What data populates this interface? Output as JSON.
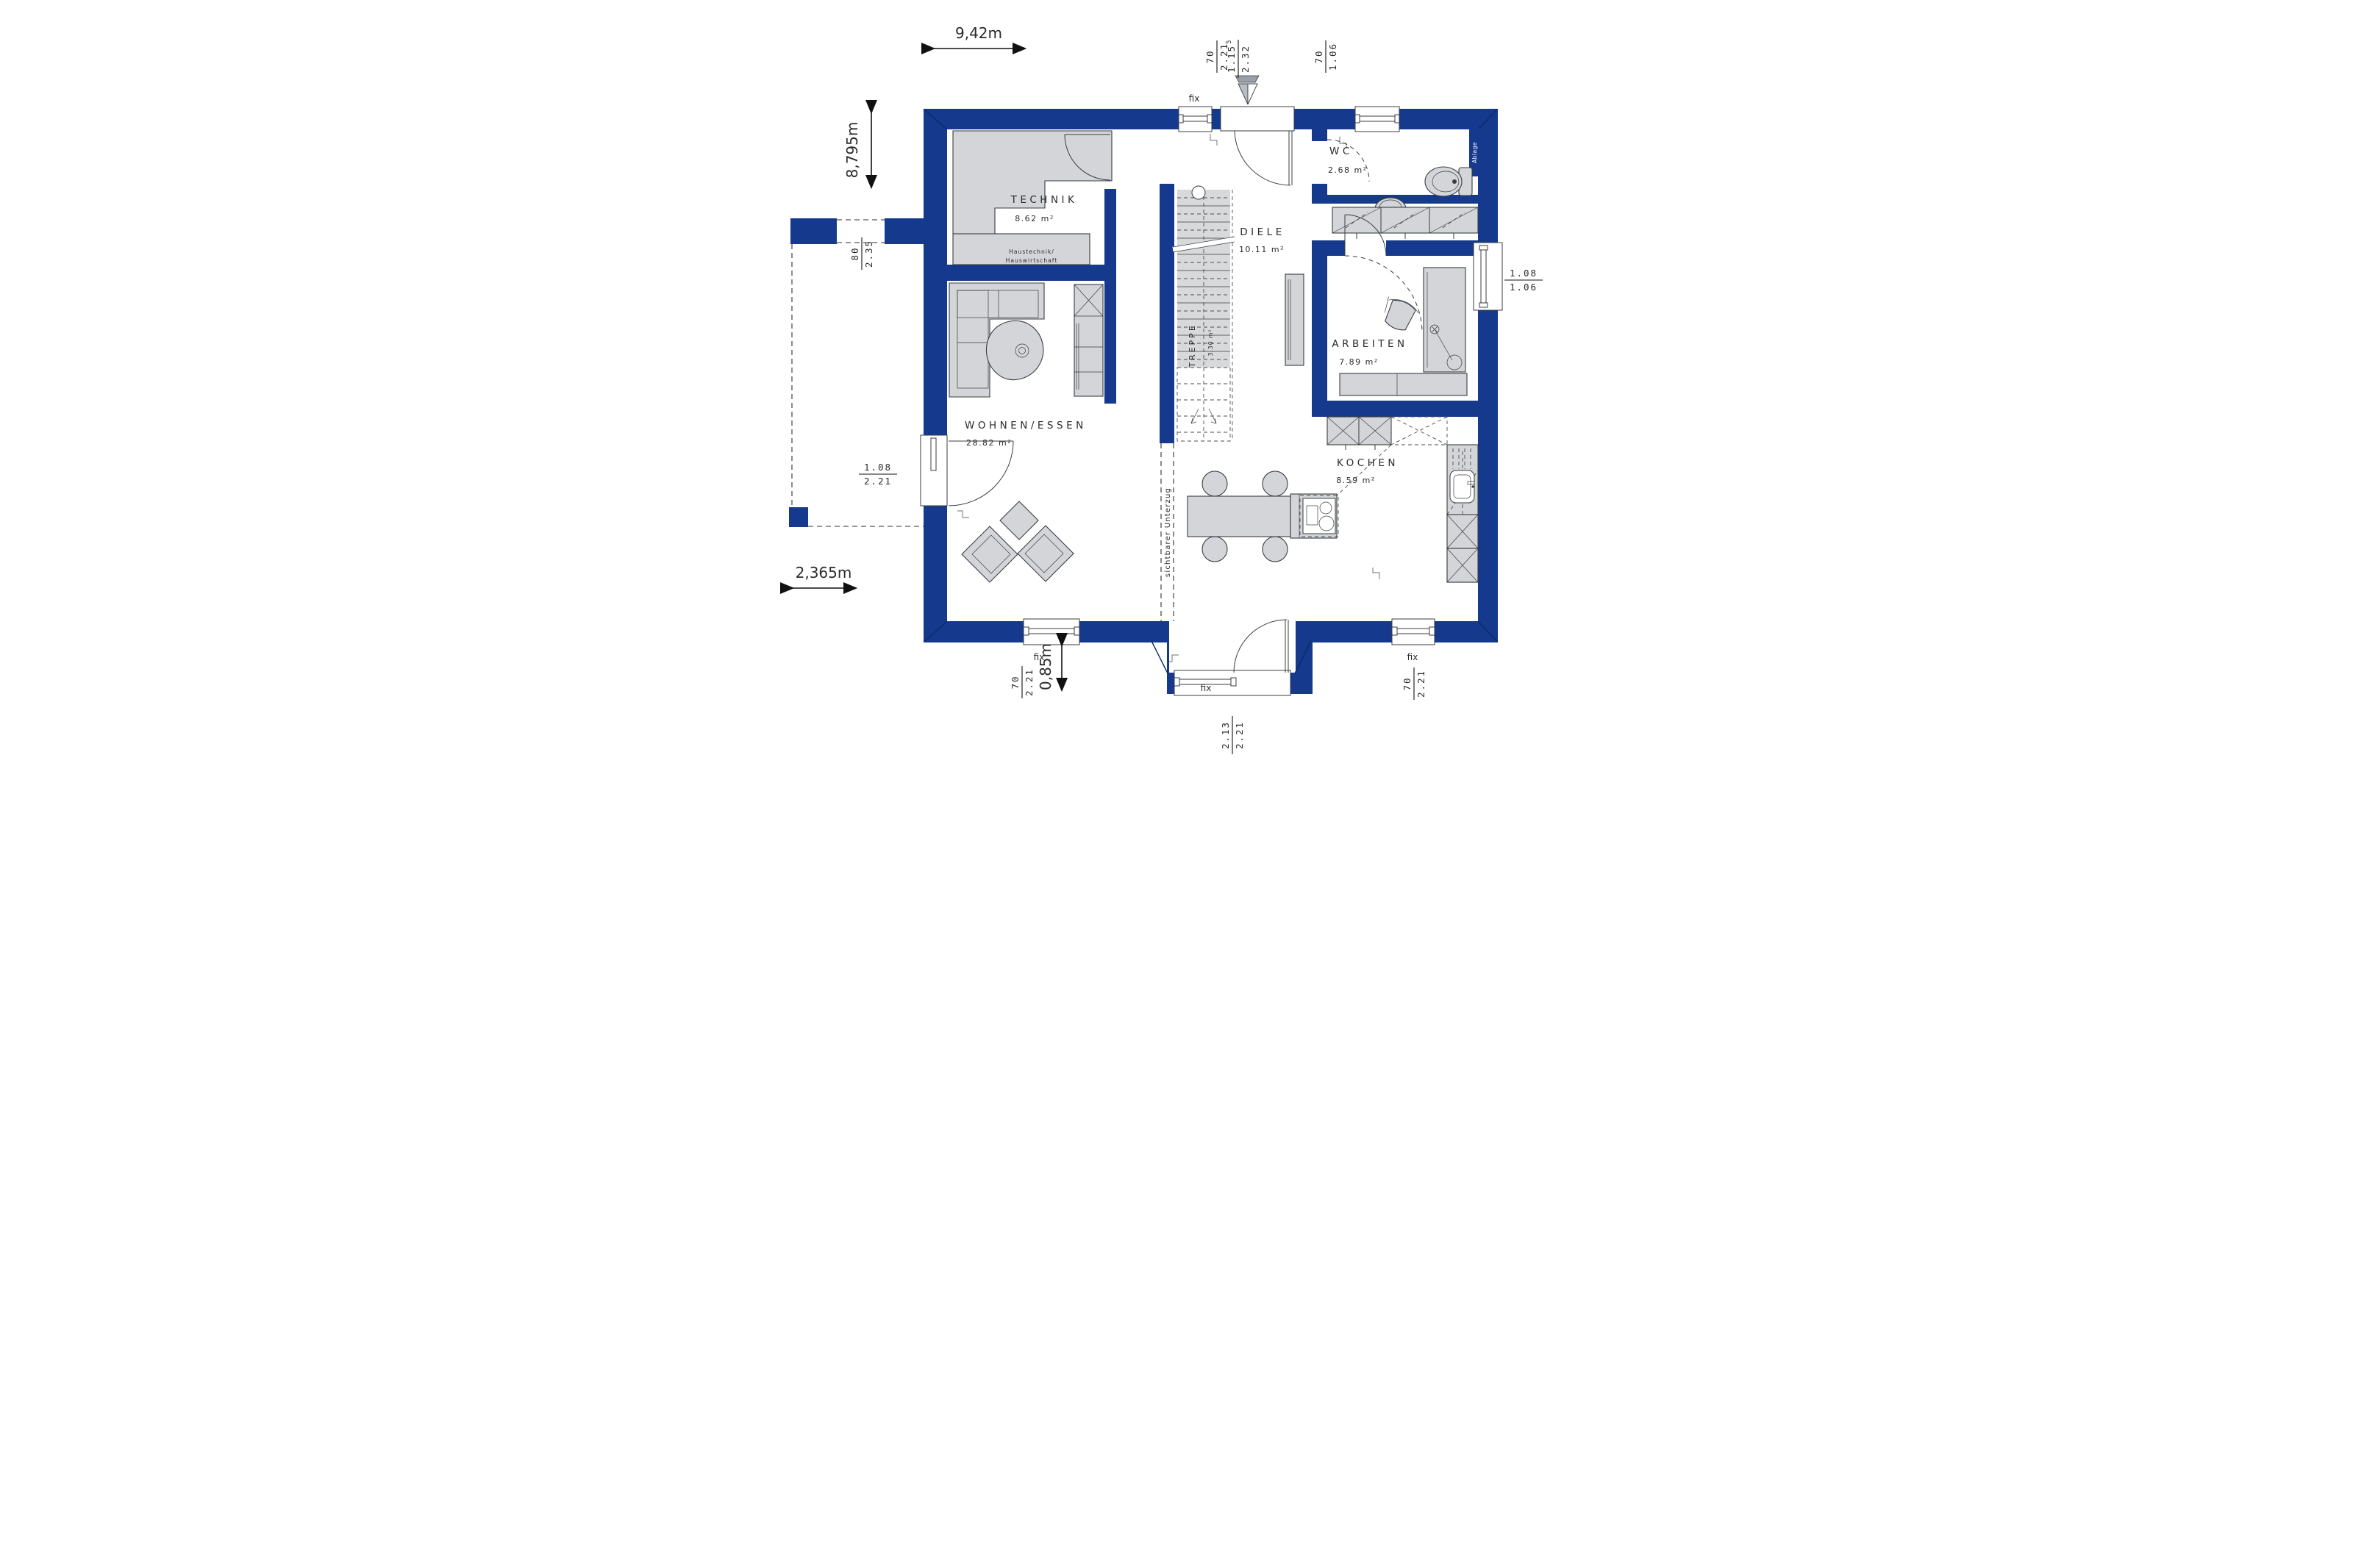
{
  "rooms": {
    "technik": {
      "name": "TECHNIK",
      "area": "8.62 m²",
      "note1": "Haustechnik/",
      "note2": "Hauswirtschaft"
    },
    "wc": {
      "name": "WC",
      "area": "2.68 m²"
    },
    "diele": {
      "name": "DIELE",
      "area": "10.11 m²"
    },
    "treppe": {
      "name": "TREPPE",
      "area": "3.30 m²"
    },
    "arbeiten": {
      "name": "ARBEITEN",
      "area": "7.89 m²"
    },
    "wohnen_essen": {
      "name": "WOHNEN/ESSEN",
      "area": "28.82 m²"
    },
    "kochen": {
      "name": "KOCHEN",
      "area": "8.59 m²"
    }
  },
  "overall_dimensions": {
    "width": "9,42m",
    "depth": "8,795m",
    "carport_width": "2,365m",
    "recess": "0,85m"
  },
  "annotations": {
    "beam": "sichtbarer Unterzug",
    "shelf": "Ablage",
    "fix": "fix"
  },
  "openings": {
    "top_window": {
      "w": "70",
      "h": "2.21"
    },
    "entrance_door": {
      "w": "1.15",
      "sup": "5",
      "h": "2.32"
    },
    "wc_window": {
      "w": "70",
      "h": "1.06"
    },
    "carport_passage": {
      "w": "80",
      "h": "2.35"
    },
    "terrace_door_left": {
      "w": "1.08",
      "h": "2.21"
    },
    "office_window": {
      "w": "1.08",
      "h": "1.06"
    },
    "living_window": {
      "w": "70",
      "h": "2.21"
    },
    "terrace_door_south": {
      "w": "2.13",
      "h": "2.21"
    },
    "kitchen_window": {
      "w": "70",
      "h": "2.21"
    }
  },
  "colors": {
    "wall": "#15398c",
    "wallshade": "#0d2a66",
    "furniture": "#d3d5d8",
    "outline": "#3a3e42",
    "text": "#2b2b2b",
    "floor": "#ffffff"
  }
}
